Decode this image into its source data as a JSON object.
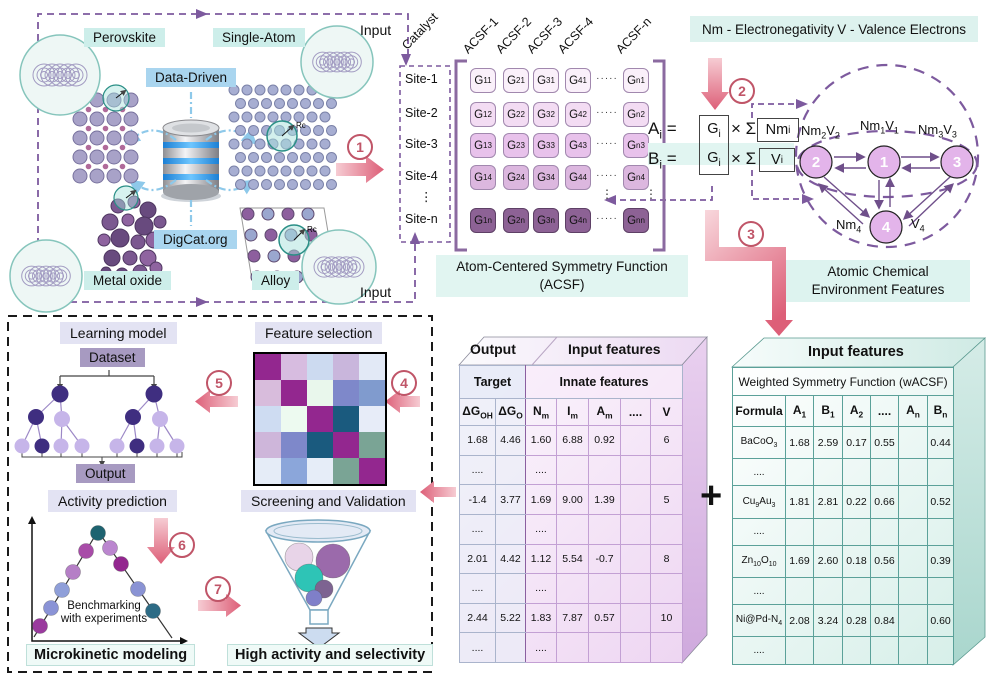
{
  "colors": {
    "accent_pink_light": "#f6ccd3",
    "accent_pink_dark": "#dd5f78",
    "step_rose": "#c05568",
    "dashed_purple": "#7d5a9e",
    "teal_label_bg": "#cdeeea",
    "teal_caption_bg": "#e1f5f1",
    "legend_bg": "#ddf2ee",
    "blue_label_bg": "#a9d5ef",
    "lavender_bg": "#e3e3f3",
    "purple_box_bg": "#a79ac1",
    "tree_dark": "#3f2e80",
    "tree_light": "#c6b5e9",
    "node_fill": "#e3b4ea"
  },
  "panel_top_left": {
    "perovskite": "Perovskite",
    "single_atom": "Single-Atom",
    "data_driven": "Data-Driven",
    "digcat": "DigCat.org",
    "metal_oxide": "Metal oxide",
    "alloy": "Alloy",
    "input_top": "Input",
    "input_bottom": "Input",
    "rc": "Rc"
  },
  "steps": {
    "s1": "1",
    "s2": "2",
    "s3": "3",
    "s4": "4",
    "s5": "5",
    "s6": "6",
    "s7": "7"
  },
  "acsf": {
    "corner": "Catalyst",
    "cols": [
      "ACSF-1",
      "ACSF-2",
      "ACSF-3",
      "ACSF-4",
      "ACSF-n"
    ],
    "sites": [
      "Site-1",
      "Site-2",
      "Site-3",
      "Site-4",
      "Site-n"
    ],
    "row_colors": [
      "#faf0fa",
      "#f3dcf3",
      "#e8c2eb",
      "#dcb7df",
      "#8d6295"
    ],
    "rows": [
      [
        [
          "G",
          {
            "s": "11"
          }
        ],
        [
          "G",
          {
            "s": "21"
          }
        ],
        [
          "G",
          {
            "s": "31"
          }
        ],
        [
          "G",
          {
            "s": "41"
          }
        ],
        [
          "G",
          {
            "s": "n1"
          }
        ]
      ],
      [
        [
          "G",
          {
            "s": "12"
          }
        ],
        [
          "G",
          {
            "s": "22"
          }
        ],
        [
          "G",
          {
            "s": "32"
          }
        ],
        [
          "G",
          {
            "s": "42"
          }
        ],
        [
          "G",
          {
            "s": "n2"
          }
        ]
      ],
      [
        [
          "G",
          {
            "s": "13"
          }
        ],
        [
          "G",
          {
            "s": "23"
          }
        ],
        [
          "G",
          {
            "s": "33"
          }
        ],
        [
          "G",
          {
            "s": "43"
          }
        ],
        [
          "G",
          {
            "s": "n3"
          }
        ]
      ],
      [
        [
          "G",
          {
            "s": "14"
          }
        ],
        [
          "G",
          {
            "s": "24"
          }
        ],
        [
          "G",
          {
            "s": "34"
          }
        ],
        [
          "G",
          {
            "s": "44"
          }
        ],
        [
          "G",
          {
            "s": "n4"
          }
        ]
      ],
      [
        [
          "G",
          {
            "s": "1n"
          }
        ],
        [
          "G",
          {
            "s": "2n"
          }
        ],
        [
          "G",
          {
            "s": "3n"
          }
        ],
        [
          "G",
          {
            "s": "4n"
          }
        ],
        [
          "G",
          {
            "s": "nn"
          }
        ]
      ]
    ],
    "hdots": "·····",
    "vdots": "⋮",
    "caption1": "Atom-Centered Symmetry Function",
    "caption2": "(ACSF)"
  },
  "legend": {
    "nm": "Nm - Electronegativity",
    "v": "V - Valence Electrons"
  },
  "equations": {
    "a_lhs": [
      "A",
      {
        "s": "i"
      },
      " ="
    ],
    "b_lhs": [
      "B",
      {
        "s": "i"
      },
      " ="
    ],
    "g": [
      "G",
      {
        "s": "i"
      }
    ],
    "mul": "× Σ",
    "a_box": [
      "Nm",
      {
        "s": "i"
      }
    ],
    "b_box": [
      "V",
      {
        "s": "i"
      }
    ]
  },
  "graph": {
    "nodes": [
      "2",
      "1",
      "3",
      "4"
    ],
    "label2": [
      "Nm",
      {
        "s": "2"
      },
      "V",
      {
        "s": "2"
      }
    ],
    "label1": [
      "Nm",
      {
        "s": "1"
      },
      "V",
      {
        "s": "1"
      }
    ],
    "label3": [
      "Nm",
      {
        "s": "3"
      },
      "V",
      {
        "s": "3"
      }
    ],
    "label4nm": [
      "Nm",
      {
        "s": "4"
      }
    ],
    "label4v": [
      "V",
      {
        "s": "4"
      }
    ],
    "caption1": "Atomic Chemical",
    "caption2": "Environment Features"
  },
  "workflow": {
    "learning_model": "Learning model",
    "dataset": "Dataset",
    "output": "Output",
    "feature_selection": "Feature selection",
    "activity_prediction": "Activity prediction",
    "benchmark1": "Benchmarking",
    "benchmark2": "with experiments",
    "microkinetic": "Microkinetic modeling",
    "screening": "Screening and Validation",
    "high_activity": "High activity and selectivity",
    "heatmap": [
      [
        "#93278f",
        "#d7bce0",
        "#ccdaf0",
        "#c9b6dc",
        "#e2e9f6"
      ],
      [
        "#d8bcdc",
        "#93278f",
        "#e9f7ec",
        "#7e88ca",
        "#809bce"
      ],
      [
        "#cedcf2",
        "#edfaf0",
        "#93278f",
        "#1a5a7e",
        "#e7ecf8"
      ],
      [
        "#ceb6da",
        "#7e88ca",
        "#1a5a7e",
        "#93278f",
        "#7aa495"
      ],
      [
        "#e5ecf7",
        "#8ba6da",
        "#e6edf8",
        "#7aa495",
        "#93278f"
      ]
    ],
    "volcano_dots": [
      {
        "x": 40,
        "y": 626,
        "c": "#9a3a9e"
      },
      {
        "x": 51,
        "y": 608,
        "c": "#8a93d6"
      },
      {
        "x": 62,
        "y": 590,
        "c": "#8f9fd9"
      },
      {
        "x": 73,
        "y": 572,
        "c": "#b57fc6"
      },
      {
        "x": 86,
        "y": 551,
        "c": "#a84ca8"
      },
      {
        "x": 98,
        "y": 533,
        "c": "#1e6370"
      },
      {
        "x": 110,
        "y": 548,
        "c": "#bb86cf"
      },
      {
        "x": 121,
        "y": 564,
        "c": "#93278f"
      },
      {
        "x": 138,
        "y": 589,
        "c": "#8a93d4"
      },
      {
        "x": 153,
        "y": 611,
        "c": "#2d6b85"
      }
    ],
    "funnel_balls": [
      {
        "x": 299,
        "y": 557,
        "r": 14,
        "c": "#e8d4e8"
      },
      {
        "x": 333,
        "y": 561,
        "r": 17,
        "c": "#9b6aab"
      },
      {
        "x": 309,
        "y": 578,
        "r": 14,
        "c": "#2ec4b6"
      },
      {
        "x": 324,
        "y": 589,
        "r": 9,
        "c": "#7d6391"
      },
      {
        "x": 314,
        "y": 598,
        "r": 8,
        "c": "#7f7fc9"
      }
    ]
  },
  "table_innate": {
    "header_left": "Output",
    "header_right": "Input features",
    "sub_left": "Target",
    "sub_right": "Innate features",
    "cols": [
      [
        "ΔG",
        {
          "s": "OH"
        }
      ],
      [
        "ΔG",
        {
          "s": "O"
        }
      ],
      [
        "N",
        {
          "s": "m"
        }
      ],
      [
        "I",
        {
          "s": "m"
        }
      ],
      [
        "A",
        {
          "s": "m"
        }
      ],
      "....",
      "V"
    ],
    "rows": [
      [
        "1.68",
        "4.46",
        "1.60",
        "6.88",
        "0.92",
        "",
        "6"
      ],
      [
        "....",
        "",
        "....",
        "",
        "",
        "",
        ""
      ],
      [
        "-1.4",
        "3.77",
        "1.69",
        "9.00",
        "1.39",
        "",
        "5"
      ],
      [
        "....",
        "",
        "....",
        "",
        "",
        "",
        ""
      ],
      [
        "2.01",
        "4.42",
        "1.12",
        "5.54",
        "-0.7",
        "",
        "8"
      ],
      [
        "....",
        "",
        "....",
        "",
        "",
        "",
        ""
      ],
      [
        "2.44",
        "5.22",
        "1.83",
        "7.87",
        "0.57",
        "",
        "10"
      ],
      [
        "....",
        "",
        "....",
        "",
        "",
        "",
        ""
      ]
    ]
  },
  "plus": "+",
  "table_wacsf": {
    "header": "Input features",
    "sub": "Weighted Symmetry Function  (wACSF)",
    "cols": [
      "Formula",
      [
        "A",
        {
          "s": "1"
        }
      ],
      [
        "B",
        {
          "s": "1"
        }
      ],
      [
        "A",
        {
          "s": "2"
        }
      ],
      "....",
      [
        "A",
        {
          "s": "n"
        }
      ],
      [
        "B",
        {
          "s": "n"
        }
      ]
    ],
    "rows": [
      [
        [
          "BaCoO",
          {
            "s": "3"
          }
        ],
        "1.68",
        "2.59",
        "0.17",
        "0.55",
        "",
        "0.44"
      ],
      [
        "....",
        "",
        "",
        "",
        "",
        "",
        ""
      ],
      [
        [
          "Cu",
          {
            "s": "9"
          },
          "Au",
          {
            "s": "3"
          }
        ],
        "1.81",
        "2.81",
        "0.22",
        "0.66",
        "",
        "0.52"
      ],
      [
        "....",
        "",
        "",
        "",
        "",
        "",
        ""
      ],
      [
        [
          "Zn",
          {
            "s": "10"
          },
          "O",
          {
            "s": "10"
          }
        ],
        "1.69",
        "2.60",
        "0.18",
        "0.56",
        "",
        "0.39"
      ],
      [
        "....",
        "",
        "",
        "",
        "",
        "",
        ""
      ],
      [
        [
          "Ni@Pd-N",
          {
            "s": "4"
          }
        ],
        "2.08",
        "3.24",
        "0.28",
        "0.84",
        "",
        "0.60"
      ],
      [
        "....",
        "",
        "",
        "",
        "",
        "",
        ""
      ]
    ]
  }
}
